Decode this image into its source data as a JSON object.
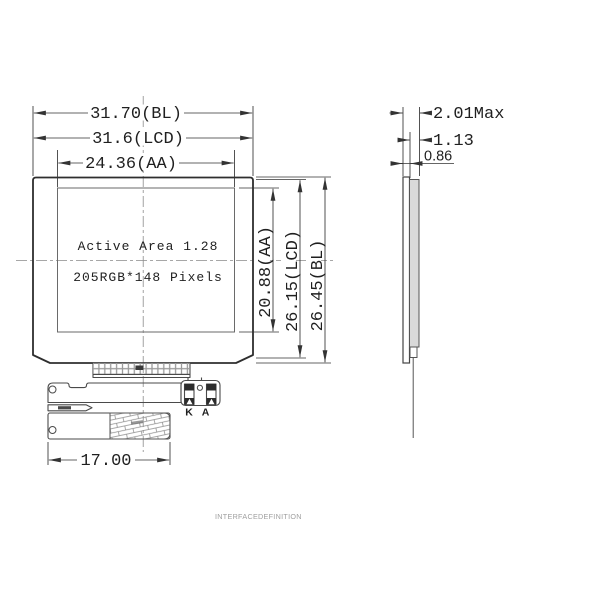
{
  "front_view": {
    "width_bl": "31.70(BL)",
    "width_lcd": "31.6(LCD)",
    "width_aa": "24.36(AA)",
    "height_aa": "20.88(AA)",
    "height_lcd": "26.15(LCD)",
    "height_bl": "26.45(BL)",
    "active_area_label": "Active Area 1.28",
    "resolution_label": "205RGB*148 Pixels",
    "fpc_width": "17.00",
    "pin_k": "K",
    "pin_a": "A"
  },
  "side_view": {
    "thickness_max": "2.01Max",
    "thickness_lcd": "1.13",
    "thickness_bl": "0.86"
  },
  "footer": {
    "caption": "INTERFACEDEFINITION"
  },
  "colors": {
    "line": "#2e2e2e",
    "dimension": "#333333",
    "glass_fill": "#d9d9d9",
    "faint_text": "#949494",
    "background": "#ffffff"
  }
}
